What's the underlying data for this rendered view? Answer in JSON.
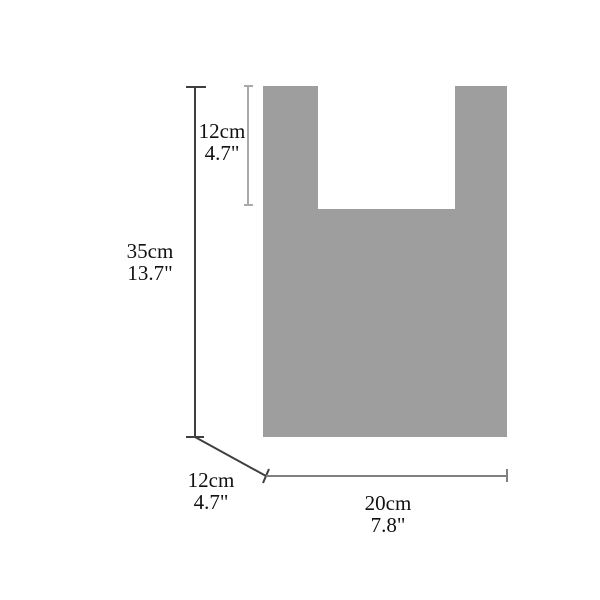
{
  "colors": {
    "bag": "#9e9e9e",
    "notch": "#ffffff",
    "height_line": "#3f3f3f",
    "depth_line": "#3f3f3f",
    "width_line": "#808080",
    "handle_line": "#a9a9a9"
  },
  "dimensions": {
    "handle_height": {
      "cm": "12cm",
      "inch": "4.7\""
    },
    "total_height": {
      "cm": "35cm",
      "inch": "13.7\""
    },
    "depth": {
      "cm": "12cm",
      "inch": "4.7\""
    },
    "width": {
      "cm": "20cm",
      "inch": "7.8\""
    }
  }
}
